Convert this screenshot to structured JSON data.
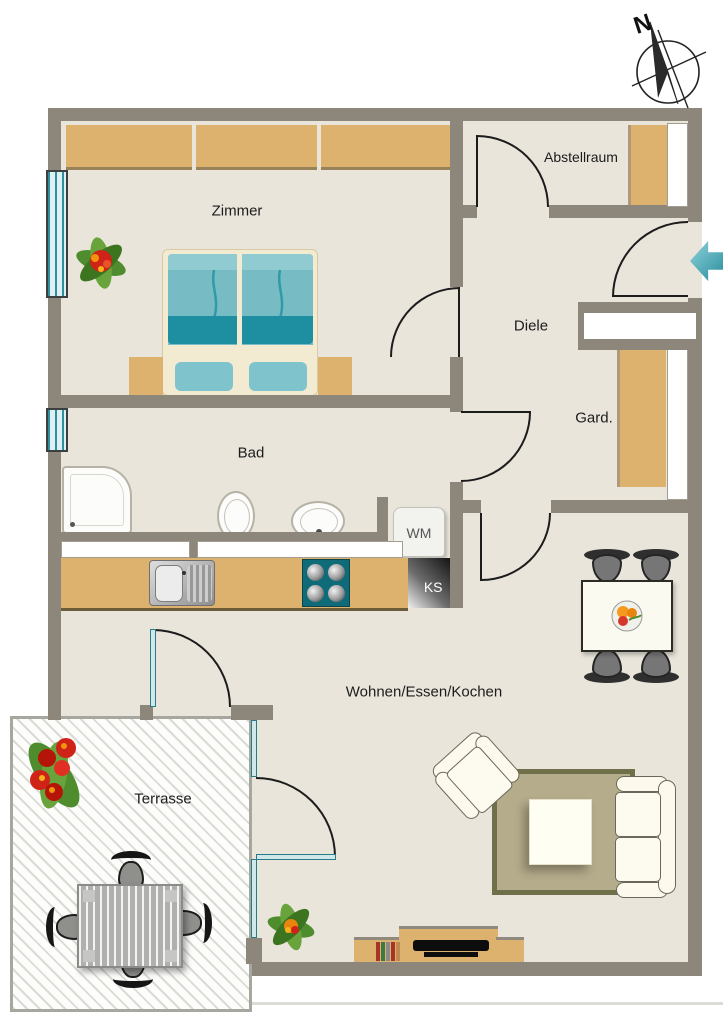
{
  "plan": {
    "compass_label": "N",
    "rooms": {
      "zimmer": {
        "label": "Zimmer"
      },
      "abstellraum": {
        "label": "Abstellraum"
      },
      "diele": {
        "label": "Diele"
      },
      "garderobe": {
        "label": "Gard."
      },
      "bad": {
        "label": "Bad"
      },
      "wohnen": {
        "label": "Wohnen/Essen/Kochen"
      },
      "terrasse": {
        "label": "Terrasse"
      }
    },
    "appliances": {
      "washing_machine": {
        "label": "WM"
      },
      "fridge": {
        "label": "KS"
      }
    },
    "colors": {
      "wall": "#8d877b",
      "floor": "#e9e5db",
      "furniture_wood": "#ddb26e",
      "bed_teal": "#1e8fa0",
      "entry_arrow": "#2e8f9e",
      "rug": "#b5ac8b",
      "rug_border": "#6f7049"
    }
  }
}
